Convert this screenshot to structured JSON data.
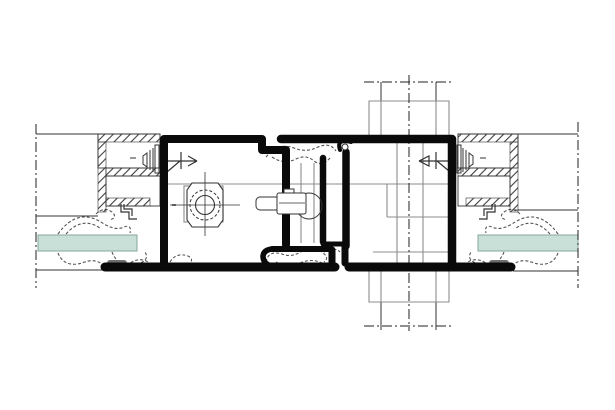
{
  "drawing": {
    "type": "technical-section-detail",
    "description": "Horizontal section detail of a profile joint: two dark frame profiles with central thermal-break gasket, glazing panes, wall insulation blocks and construction centerlines",
    "components": [
      {
        "name": "left-sash-profile",
        "label": "left frame profile"
      },
      {
        "name": "right-sash-profile",
        "label": "right frame profile"
      },
      {
        "name": "thermal-break-gasket",
        "label": "central gasket / thermal break"
      },
      {
        "name": "glass-pane-left",
        "label": "left glazing pane"
      },
      {
        "name": "glass-pane-right",
        "label": "right glazing pane"
      },
      {
        "name": "wall-insulation-left",
        "label": "left wall insulation block"
      },
      {
        "name": "wall-insulation-right",
        "label": "right wall insulation block"
      },
      {
        "name": "cylinder-fitting",
        "label": "cylinder / screw port"
      },
      {
        "name": "latch-bolt",
        "label": "latch bolt"
      },
      {
        "name": "mullion-post",
        "label": "crossing mullion post"
      },
      {
        "name": "centerlines",
        "label": "dash-dot construction axes"
      }
    ],
    "colors": {
      "background": "#ffffff",
      "profile": "#0a0a0a",
      "thin": "#333333",
      "gray": "#8d8d8d",
      "centerline": "#222222",
      "gasket": "#555555",
      "glass_fill": "#c8e0d8",
      "glass_edge": "#86a79e",
      "hatch": "#3f3f3f",
      "pill": "#6f6f6f"
    }
  }
}
